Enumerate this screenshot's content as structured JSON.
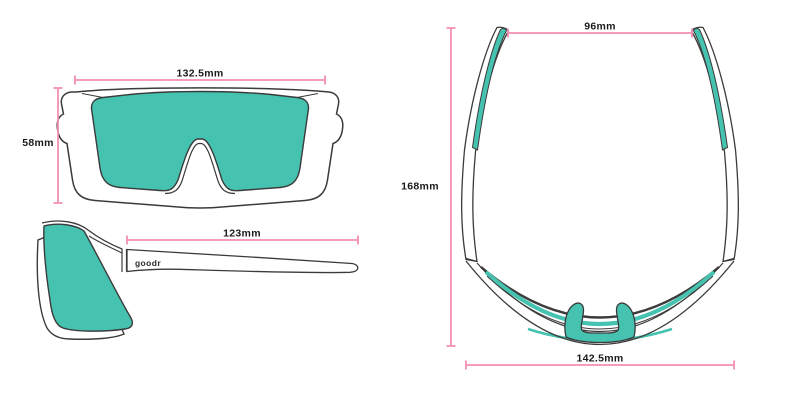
{
  "diagram": {
    "product": "wraparound shield sunglasses",
    "views": {
      "front": "front view",
      "side": "side view",
      "top": "top view"
    },
    "brand_logo": "goodr",
    "dimensions": {
      "front_width": "132.5mm",
      "front_height": "58mm",
      "temple_length": "123mm",
      "temple_spread": "96mm",
      "overall_length": "168mm",
      "frame_width": "142.5mm"
    },
    "colors": {
      "dimension_pink": "#F48FB1",
      "lens_teal": "#45C3B0",
      "outline_gray": "#3B3B3B",
      "label_black": "#1A1A1A",
      "background": "#FFFFFF"
    }
  }
}
